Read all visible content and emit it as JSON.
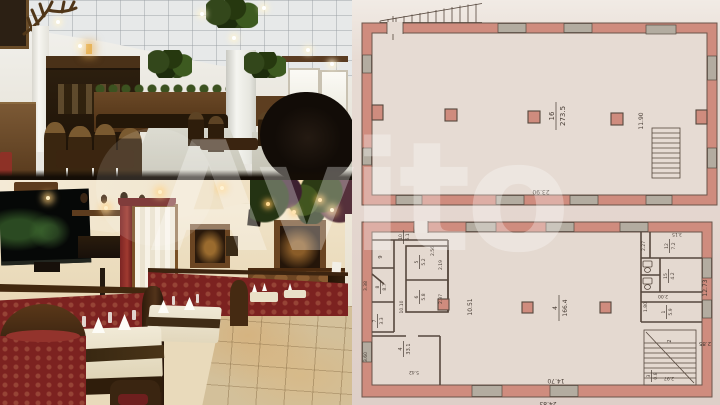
{
  "watermark": {
    "text": "Avito"
  },
  "colors": {
    "plan_wall": "#cf8c7e",
    "plan_paper": "#e4d7d1",
    "watermark": "#ffffff"
  },
  "plans": {
    "top": {
      "hall": {
        "num": "16",
        "area": "273.5"
      },
      "dim_height": "11.90",
      "dim_width": "23.90"
    },
    "bottom": {
      "hall": {
        "num": "4",
        "area": "166.4"
      },
      "dim_hall_height": "10.51",
      "dim_width_inner": "14.70",
      "dim_width_outer": "24.83",
      "dim_right": "12.73",
      "dim_right_small": "2.85",
      "rooms": {
        "r10": {
          "num": "10",
          "area": "6.1"
        },
        "r9": {
          "num": "9"
        },
        "r5": {
          "num": "5",
          "area": "5.2"
        },
        "r8": {
          "num": "8",
          "area": "8.7"
        },
        "r6": {
          "num": "6",
          "area": "5.8"
        },
        "r7": {
          "num": "7",
          "area": "3.3"
        },
        "r4": {
          "num": "4",
          "area": "33.1"
        },
        "r12": {
          "num": "12",
          "area": "7.2"
        },
        "r15": {
          "num": "15",
          "area": "4.2"
        },
        "r1": {
          "num": "1",
          "area": "5.9"
        },
        "r2": {
          "num": "2"
        },
        "r3": {
          "num": "3",
          "area": "0.8"
        }
      },
      "dims": {
        "d219": "2.19",
        "d237": "2.37",
        "d256": "2.56",
        "d338": "3.38",
        "d1010": "10.10",
        "d360": "3.60",
        "d542": "5.42",
        "d227": "2.27",
        "d315": "3.15",
        "d200": "2.00",
        "d180": "1.80",
        "d297": "2.97"
      }
    }
  }
}
